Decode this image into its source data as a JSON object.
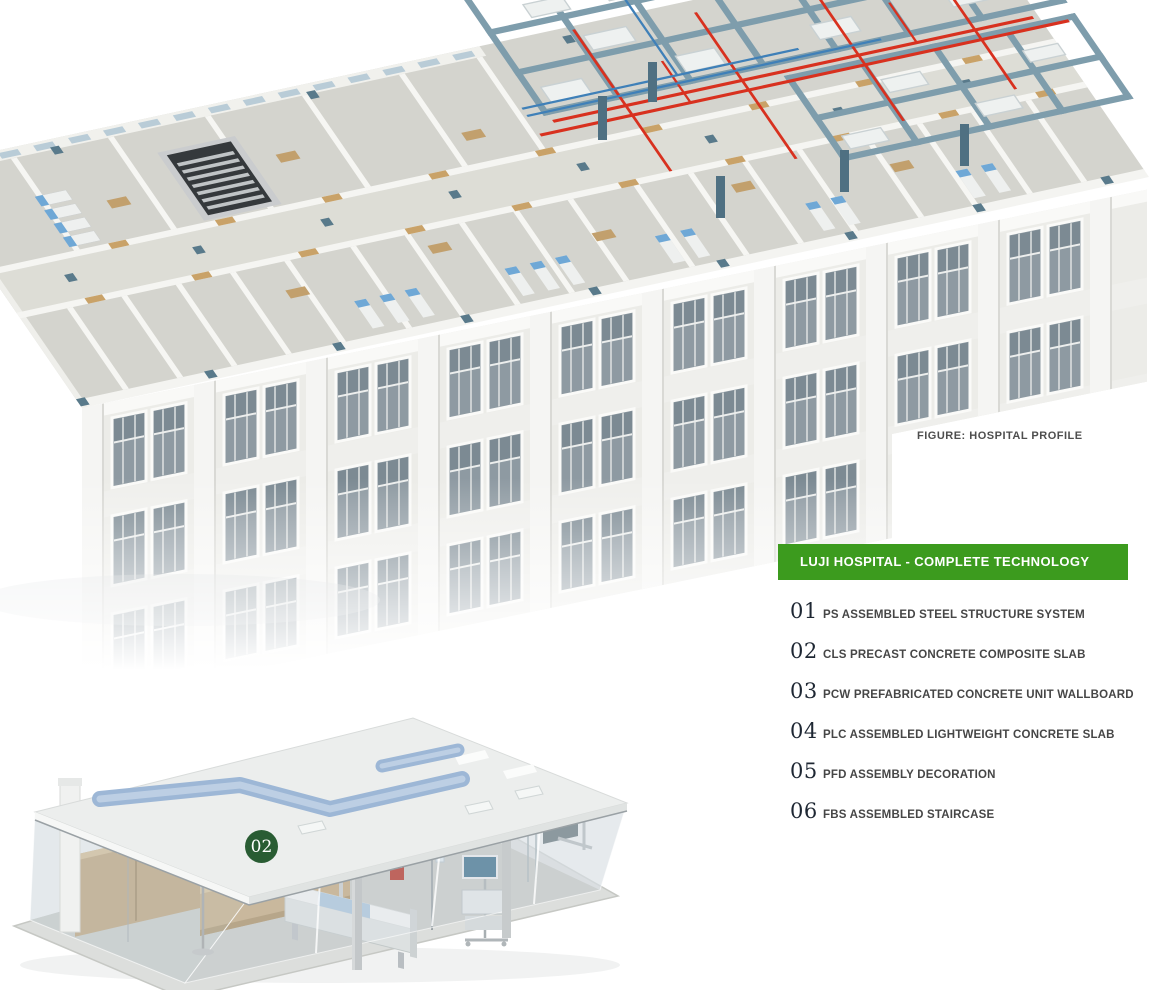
{
  "figure_caption": "FIGURE: HOSPITAL PROFILE",
  "panel": {
    "header": "LUJI HOSPITAL - COMPLETE TECHNOLOGY",
    "items": [
      {
        "num": "01",
        "label": "PS ASSEMBLED STEEL STRUCTURE SYSTEM"
      },
      {
        "num": "02",
        "label": "CLS PRECAST CONCRETE COMPOSITE SLAB"
      },
      {
        "num": "03",
        "label": "PCW PREFABRICATED CONCRETE UNIT WALLBOARD"
      },
      {
        "num": "04",
        "label": "PLC ASSEMBLED LIGHTWEIGHT CONCRETE SLAB"
      },
      {
        "num": "05",
        "label": "PFD ASSEMBLY DECORATION"
      },
      {
        "num": "06",
        "label": "FBS ASSEMBLED STAIRCASE"
      }
    ]
  },
  "room_badge": {
    "label": "02"
  },
  "colors": {
    "panel_header_green": "#3c9b1e",
    "badge_dark_green": "#295c33",
    "steel_beam_blue": "#7e9dac",
    "pipe_red": "#d8311f",
    "pipe_blue": "#3f80b8",
    "duct_blue": "#9db7d6",
    "door_wood_tan": "#c9a268",
    "column_teal": "#597a8b",
    "window_glass_gray": "#8e9aa2"
  }
}
